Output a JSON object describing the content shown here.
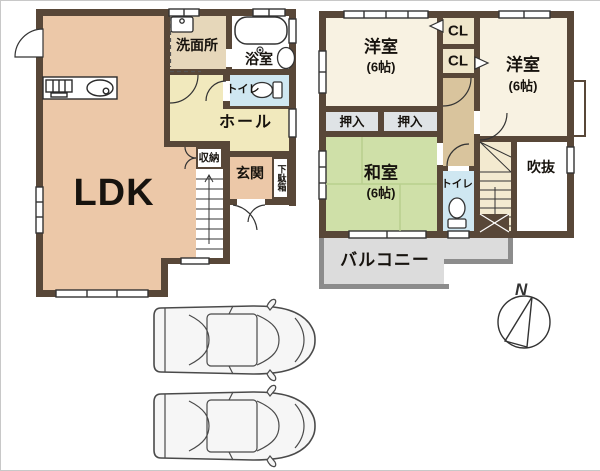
{
  "plan": {
    "floor1": {
      "rooms": {
        "ldk": "LDK",
        "washroom": "洗面所",
        "bathroom": "浴室",
        "toilet": "トイレ",
        "hall": "ホール",
        "storage": "収納",
        "entrance": "玄関",
        "shoe_cabinet": "下駄箱"
      }
    },
    "floor2": {
      "rooms": {
        "western_room_1": "洋室",
        "western_room_1_size": "(6帖)",
        "western_room_2": "洋室",
        "western_room_2_size": "(6帖)",
        "closet_1": "CL",
        "closet_2": "CL",
        "oshiire_1": "押入",
        "oshiire_2": "押入",
        "japanese_room": "和室",
        "japanese_room_size": "(6帖)",
        "toilet": "トイレ",
        "open_ceiling": "吹抜",
        "balcony": "バルコニー"
      }
    },
    "compass_north": "N",
    "parking_car_count": 2
  },
  "palette": {
    "wall": "#584738",
    "ldk_entrance_fill": "#ecc8a8",
    "washroom_fill": "#e6d7ba",
    "hall_fill": "#f1e9bd",
    "toilet_fill": "#cfe7f1",
    "tatami_fill": "#cfe0a8",
    "western_room_fill": "#f8f2e2",
    "closet_fill": "#efe6ca",
    "corridor_fill": "#d9c49d",
    "stairs2_fill": "#f3ead0",
    "oshiire_fill": "#dfe3e6",
    "balcony_fill": "#dcdcdc",
    "balcony_wall": "#8c8c8c"
  }
}
